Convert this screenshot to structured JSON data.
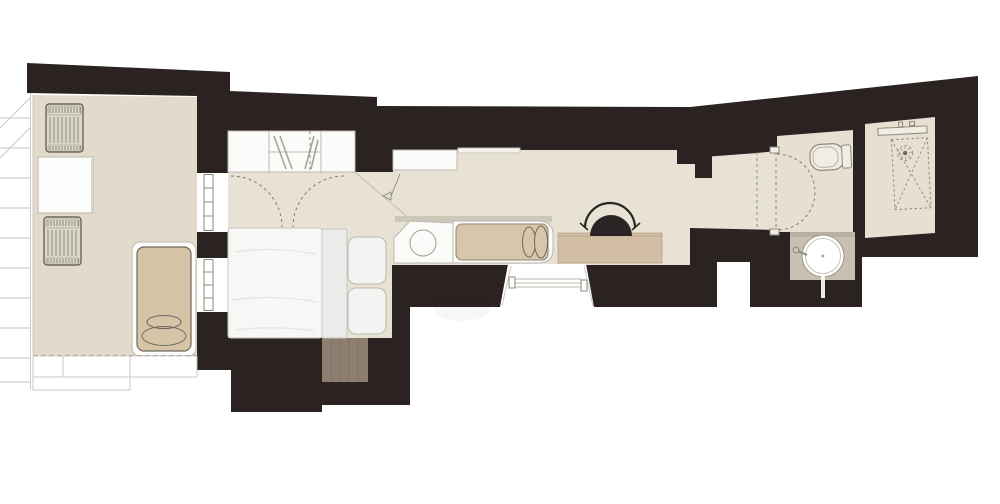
{
  "document": {
    "kind": "apartment-floor-plan-drawing",
    "visible_text": ""
  },
  "colors": {
    "background": "#ffffff",
    "wall": "#2a2322",
    "terrace_floor": "#e2dbcc",
    "interior_floor": "#e8e2d5",
    "bathroom_floor": "#e6dfd2",
    "counter_white": "#fbfbf9",
    "shelf_white": "#f6f3ea",
    "daybed_mattress": "#d8c6aa",
    "desk_wood": "#d2bfa3",
    "entry_wood": "#8d7e6f",
    "lounger_cushion": "#d6c4a7",
    "lounger_frame": "#fdfdfc",
    "chair_black": "#2a2424",
    "bed_duvet": "#f7f7f6",
    "bed_runner": "#ebebe9",
    "pillow": "#f3f3f1",
    "vanity_counter": "#c8c1b2",
    "vanity_shadow": "#a59d8d",
    "basin_white": "#ffffff",
    "outdoor_chair": "#dcd7c9",
    "table_white": "#fcfcfb",
    "fixture_fill": "#f2ede2",
    "window_white": "#ffffff"
  },
  "legend": {
    "rooms": [
      "terrace",
      "bedroom",
      "living-kitchen",
      "hallway",
      "wc",
      "shower-room",
      "entry-niche"
    ],
    "furniture": [
      "outdoor-lounge-chair-top",
      "outdoor-lounge-chair-bottom",
      "outdoor-table",
      "sun-lounger",
      "wardrobe",
      "double-bed",
      "kitchen-upper-counter",
      "kitchen-counter",
      "kitchen-sink",
      "daybed",
      "desk",
      "desk-chair",
      "toilet",
      "washbasin",
      "shower",
      "entry-step"
    ],
    "symbols": [
      "window",
      "bay-window",
      "door-swing-arc",
      "pocket-door",
      "shower-head",
      "level-marker",
      "clothes-hangers",
      "deck-stairs"
    ]
  }
}
